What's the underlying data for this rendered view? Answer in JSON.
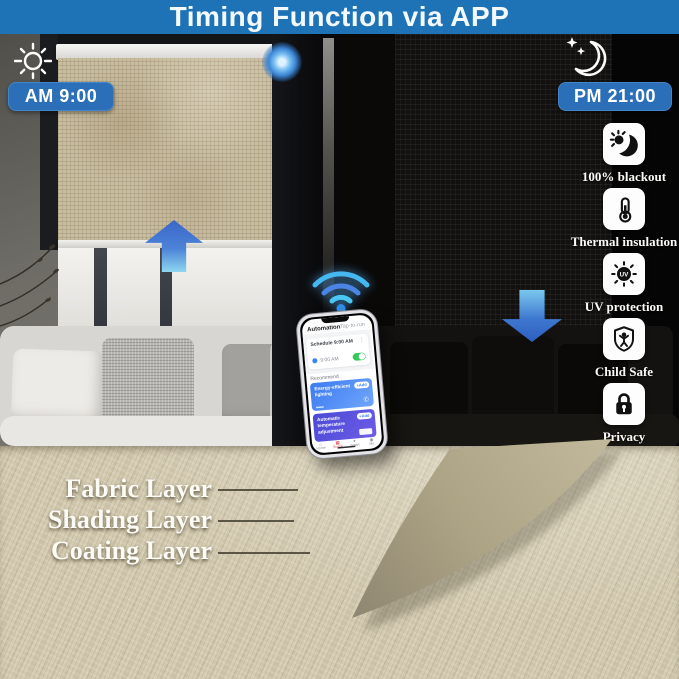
{
  "banner": {
    "title": "Timing Function via APP"
  },
  "scenes": {
    "day": {
      "time": "AM 9:00",
      "icon": "sun-icon"
    },
    "night": {
      "time": "PM 21:00",
      "icon": "moon-icon"
    }
  },
  "features": {
    "uv_text": "UV",
    "items": [
      {
        "icon": "blackout-moon-icon",
        "label": "100% blackout"
      },
      {
        "icon": "thermometer-icon",
        "label": "Thermal insulation"
      },
      {
        "icon": "uv-sun-icon",
        "label": "UV protection"
      },
      {
        "icon": "child-shield-icon",
        "label": "Child Safe"
      },
      {
        "icon": "padlock-icon",
        "label": "Privacy"
      }
    ]
  },
  "phone_app": {
    "tabs": {
      "automation": "Automation",
      "tap_to_run": "Tap-to-run"
    },
    "schedule_card": {
      "title": "Schedule 9:00 AM",
      "menu": "⋮",
      "time": "9:00 AM",
      "toggle_state": "on"
    },
    "recommend": "Recommend",
    "suggestions": [
      {
        "title": "Energy-efficient lighting",
        "action": "+Add",
        "glyph": "✆"
      },
      {
        "title": "Automatic temperature adjustment",
        "action": "+Add",
        "glyph": ""
      }
    ],
    "nav": [
      {
        "label": "Home",
        "glyph": "⌂"
      },
      {
        "label": "Scene",
        "glyph": "▦"
      },
      {
        "label": "Smart",
        "glyph": "✦"
      },
      {
        "label": "Me",
        "glyph": "◉"
      }
    ]
  },
  "layers": {
    "items": [
      "Fabric Layer",
      "Shading Layer",
      "Coating Layer"
    ]
  },
  "colors": {
    "banner_blue": "#1d73b6",
    "time_pill_blue": "#2b6fb8",
    "arrow_blue": "#3a66c8",
    "wifi_cyan": "#45b8f0",
    "toggle_green": "#34c759",
    "nav_active_red": "#e23c3c"
  }
}
